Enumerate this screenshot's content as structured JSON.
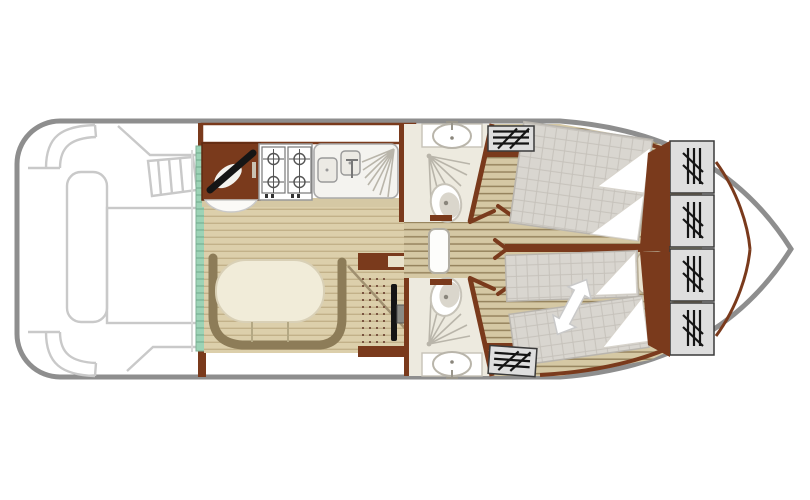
{
  "meta": {
    "kind": "boat-floor-plan",
    "view": "top-down",
    "orientation": "bow-right"
  },
  "colors": {
    "hull": "#8e8e8e",
    "deck_outline": "#c9c9c9",
    "wall_brown": "#7a3a1c",
    "dark_brown": "#5f2a12",
    "bench": "#8d7c58",
    "saloon_floor": "#dccfab",
    "saloon_floor_line": "#c2b189",
    "cabin_floor": "#d5c8a4",
    "cabin_floor_line": "#96845e",
    "teal": "#9cd3b6",
    "teal_line": "#6fa98c",
    "mattress": "#d9d6d0",
    "mattress_grid": "#c6c2bb",
    "pillow": "#eae3d0",
    "pillow_border": "#b7ad96",
    "bathroom_floor": "#edeadf",
    "fixture_line": "#b9b5aa",
    "wardrobe_fill": "#dedede",
    "wardrobe_line": "#3a3a3a",
    "table": "#f1ecd9",
    "table_border": "#d9d0b6",
    "icon_black": "#141414",
    "white": "#ffffff"
  },
  "areas": {
    "aft_deck": {
      "features": [
        "helm-seat",
        "side-bench",
        "deck-table",
        "boarding-steps",
        "companionway"
      ]
    },
    "entry": {
      "feature": "sliding-door-teal-strip"
    },
    "galley": {
      "stove_burners": 4,
      "basins": 2,
      "features": [
        "corner-cabinet",
        "gas-hob",
        "sink-with-drainer"
      ]
    },
    "saloon": {
      "features": [
        "u-shaped-dinette",
        "oval-table",
        "interior-helm-wheel",
        "instrument-console"
      ]
    },
    "bathrooms": {
      "count": 2,
      "each": [
        "washbasin",
        "shower",
        "toilet",
        "door"
      ]
    },
    "cabins": {
      "forward_port": {
        "bed": "double",
        "pillows": 2,
        "wardrobes": 1
      },
      "forward_starboard": {
        "beds": "2-single-convertible",
        "pillows": 2,
        "wardrobes": 1,
        "note_icon": "double-arrow-slide-together"
      }
    },
    "bow": {
      "wardrobe_lockers": 4
    }
  }
}
